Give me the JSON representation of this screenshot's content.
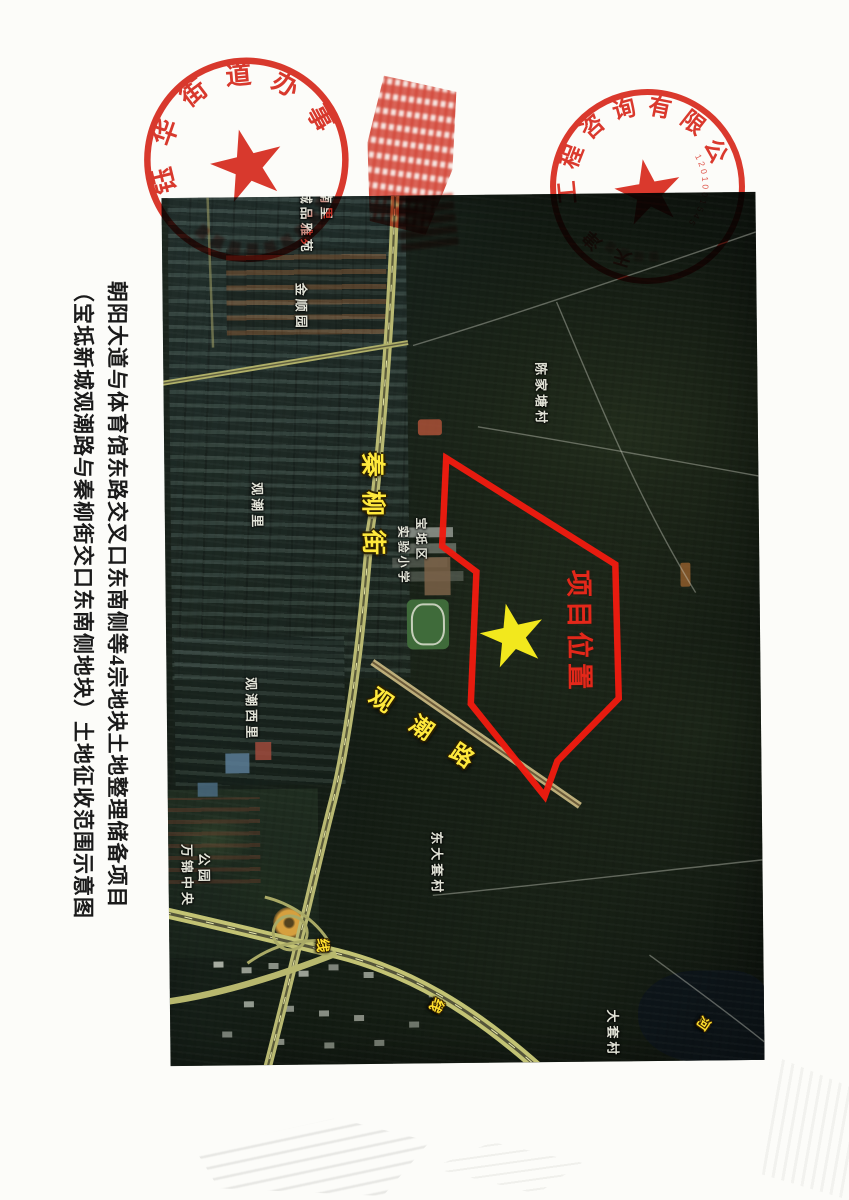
{
  "title": {
    "line1": "朝阳大道与体育馆东路交叉口东南侧等4宗地块土地整理储备项目",
    "line2": "（宝坻新城观潮路与秦柳街交口东南侧地块）土地征收范围示意图"
  },
  "stamps": {
    "left": {
      "ring_text": "钰华街道办事处"
    },
    "right": {
      "ring_text": "工程咨询有限公司",
      "lower_text": "天津市",
      "serial": "1201001545"
    }
  },
  "map": {
    "project": {
      "label": "项目位置"
    },
    "roads": {
      "qinliu": "秦柳街",
      "guanchao": "观潮路",
      "pingbao": "平宝线",
      "jinwei": "津围线",
      "chaobai": "潮白河"
    },
    "places": {
      "chengpin": "诚品雅苑",
      "nanli": "南里",
      "jinshunyuan": "金顺园",
      "guanchaoli": "观潮里",
      "baodi_qu": "宝坻区",
      "shiyan_xiaoxue": "实验小学",
      "chenjiatang": "陈家塘村",
      "guanchao_xili": "观潮西里",
      "wanjin": "万锦中央",
      "gongyuan": "公园",
      "dongdatao": "东大套村",
      "datao": "大套村"
    }
  },
  "colors": {
    "boundary": "#ee1b10",
    "star": "#f2e81d",
    "road_label": "#ffe93c",
    "place_label": "#edeee2",
    "project_label": "#e3281a",
    "stamp_ink": "#d8281c"
  }
}
